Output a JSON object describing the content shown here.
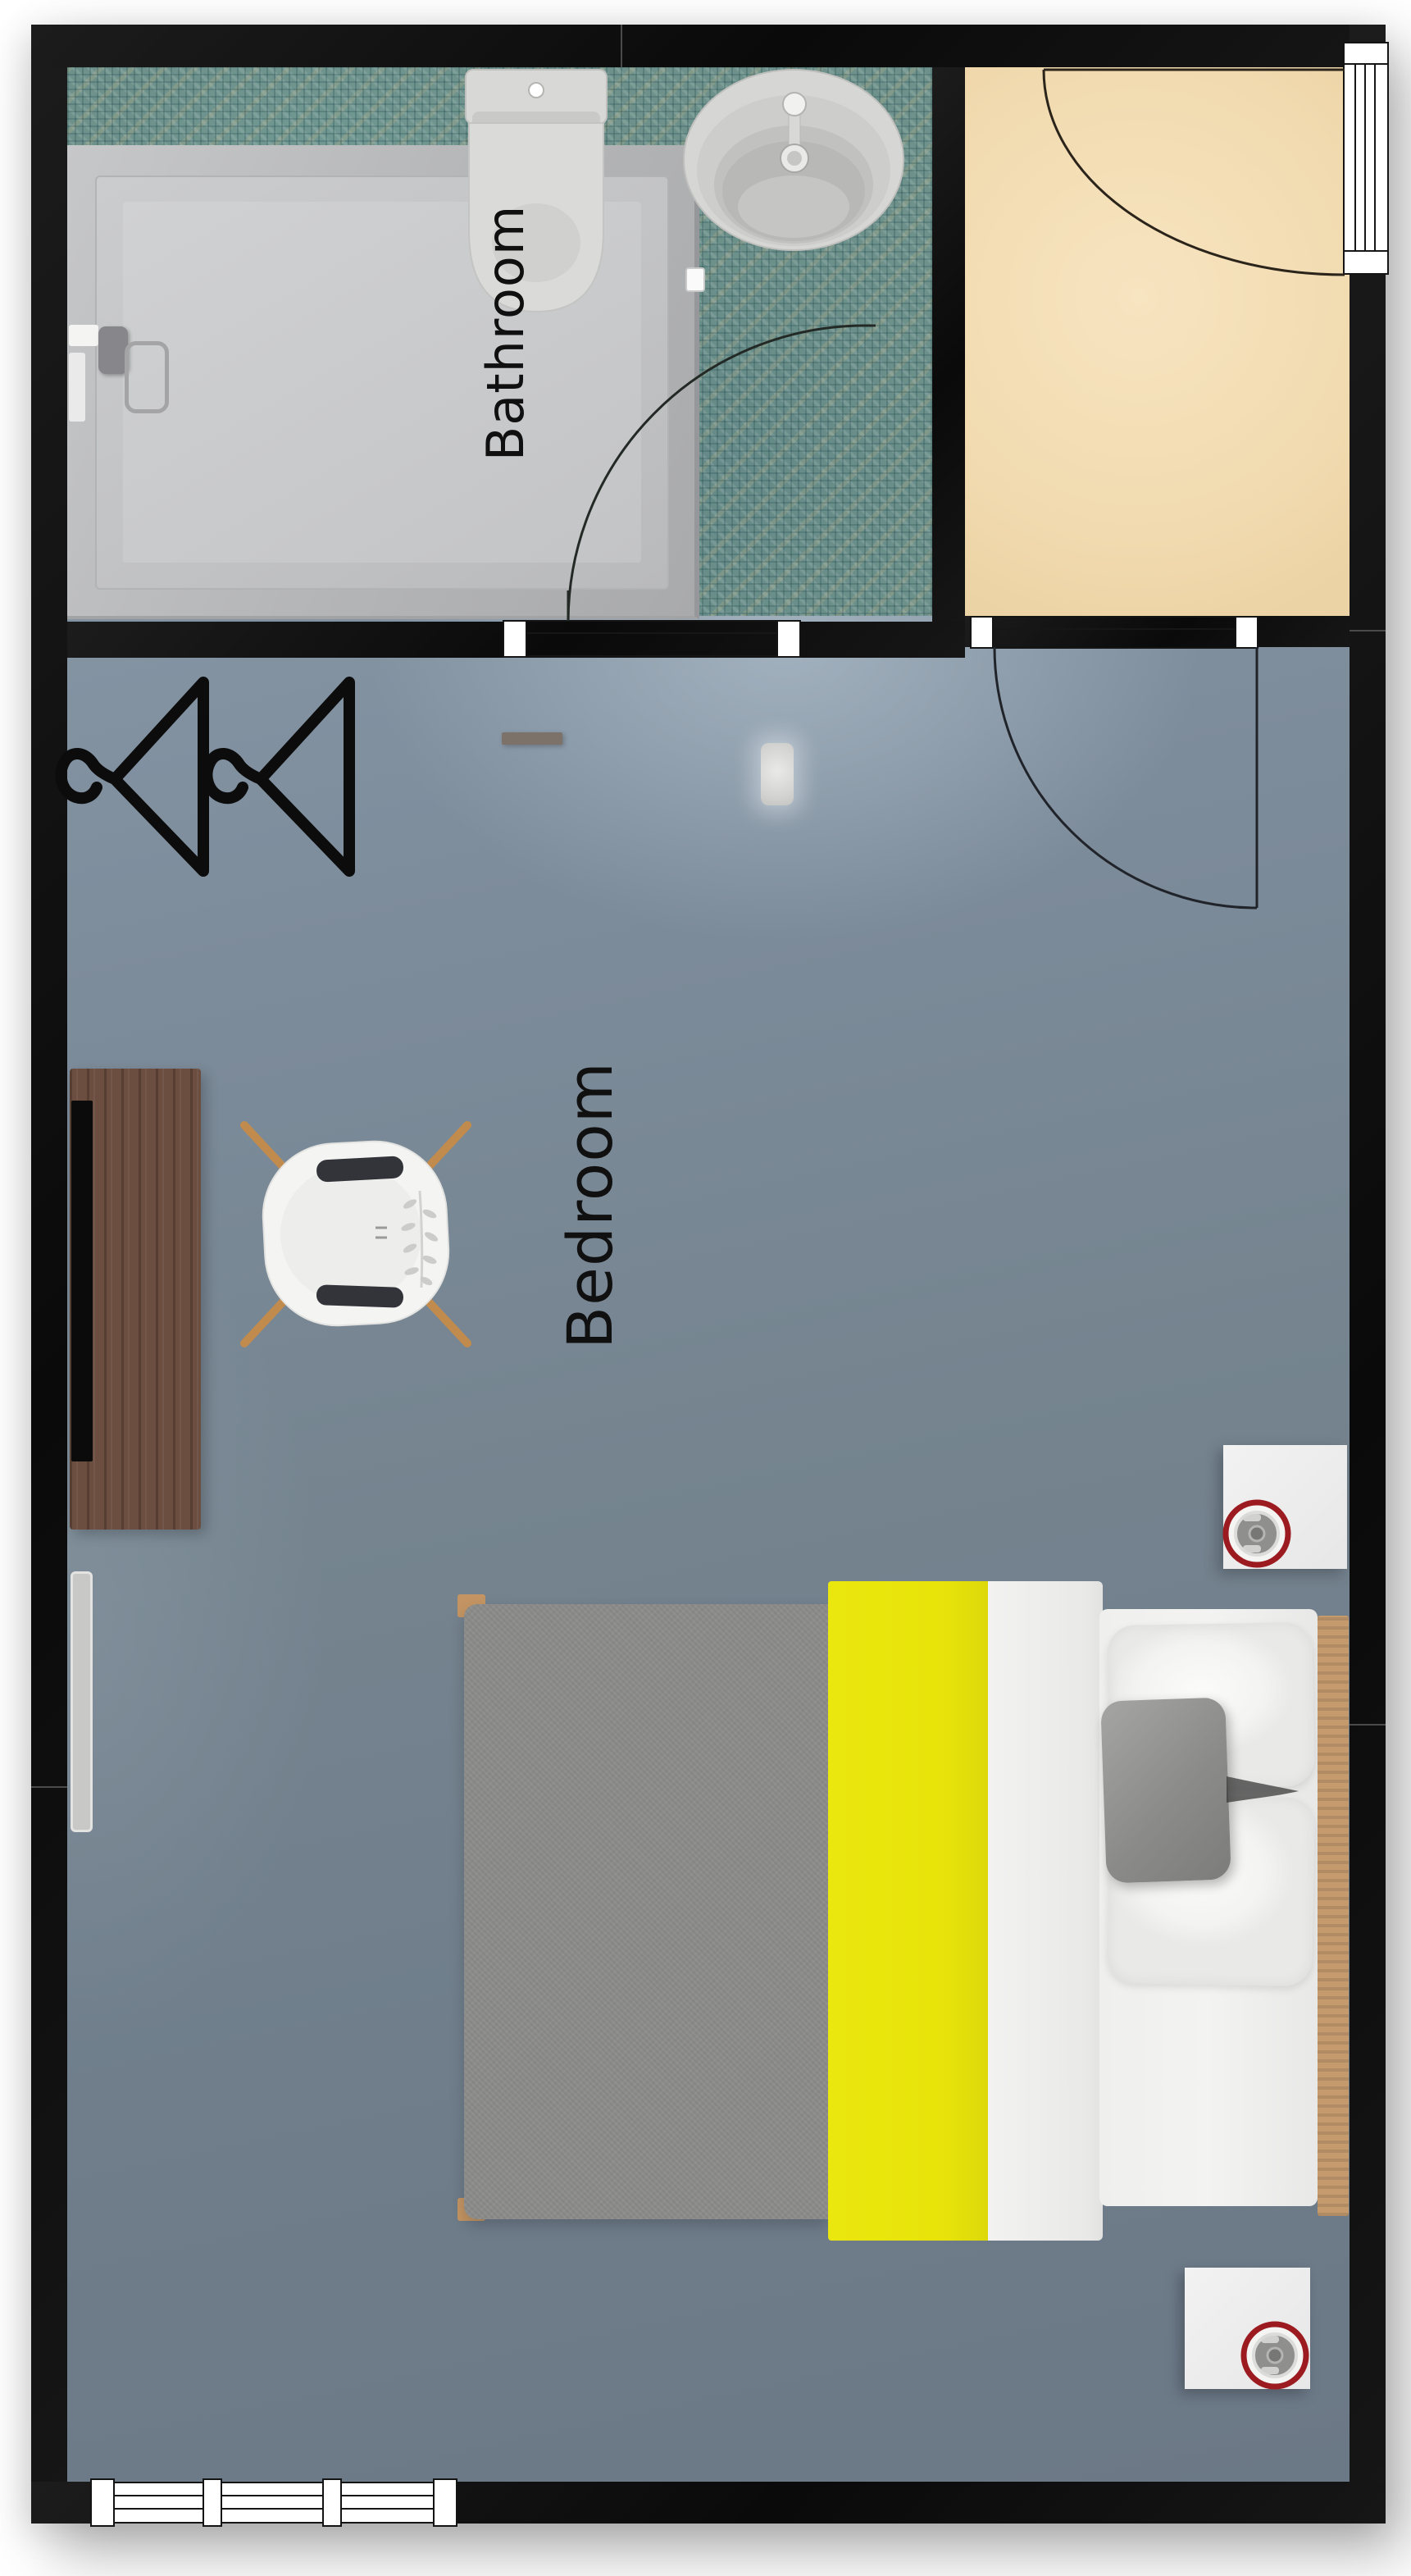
{
  "plan": {
    "type": "residential-floor-plan-top-view",
    "rooms": [
      {
        "id": "bathroom",
        "label": "Bathroom"
      },
      {
        "id": "bedroom",
        "label": "Bedroom"
      },
      {
        "id": "entry",
        "label": ""
      }
    ],
    "fixtures": [
      "shower",
      "toilet",
      "bathroom-sink",
      "clothes-hanger",
      "clothes-hanger",
      "wall-shelf",
      "ceiling-light",
      "desk",
      "monitor",
      "desk-chair",
      "radiator-panel",
      "double-bed",
      "pillow",
      "pillow",
      "throw-pillow",
      "nightstand",
      "nightstand",
      "table-lamp",
      "table-lamp",
      "door",
      "door",
      "door",
      "window",
      "window"
    ],
    "counts": {
      "hangers": 2,
      "nightstands": 2,
      "lamps": 2,
      "doors": 3,
      "pillows": 2
    }
  },
  "palette": {
    "wall": "#101010",
    "bathroom_floor_mosaic": "#6e928b",
    "entry_floor": "#f0d9ae",
    "bedroom_floor": "#78879b",
    "bed_blanket_yellow": "#e8e40a",
    "bed_blanket_gray": "#8c8c8a",
    "lamp_ring_red": "#9b1b21",
    "desk_wood": "#6b4e40",
    "bed_wood": "#c59b6e",
    "chair_shell": "#f4f4f4",
    "chair_leg_wood": "#c28b4e",
    "nightstand_white": "#efefef",
    "label_color": "#101010",
    "outside": "#ffffff"
  }
}
